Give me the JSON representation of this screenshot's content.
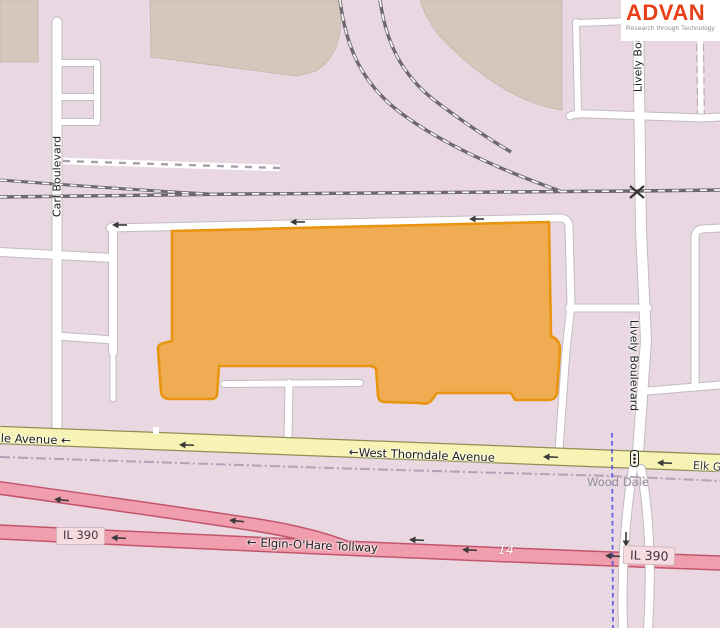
{
  "logo": {
    "brand": "ADVAN",
    "tagline": "Research through Technology",
    "brand_color": "#e8401a"
  },
  "map": {
    "street_labels": {
      "carl_boulevard": "Carl Boulevard",
      "lively_boulevard": "Lively Boulevard",
      "west_thorndale_avenue": "West Thorndale Avenue",
      "thorndale_avenue_cut": "le Avenue",
      "elgin_ohare_tollway": "Elgin-O'Hare Tollway",
      "elk_grove_cut": "Elk Gr"
    },
    "place_labels": {
      "wood_dale": "Wood Dale"
    },
    "route_shields": {
      "il_390": "IL 390",
      "route_14": "14"
    },
    "glyphs": {
      "oneway_arrow_left": "←"
    },
    "colors": {
      "background": "#e9d8e2",
      "building_block": "#d3c8bb",
      "highlight_building_fill": "#f0ac52",
      "highlight_building_stroke": "#e8940e",
      "road_white": "#ffffff",
      "road_casing": "#c3bbc3",
      "road_yellow": "#f7f3b5",
      "road_yellow_casing": "#908e55",
      "road_pink": "#f09dad",
      "road_pink_casing": "#c2556b",
      "railway_gray": "#6f696f",
      "boundary_blue": "#4d4de0",
      "boundary_purple": "#ab9cb3",
      "shield_bg": "#f5dce1",
      "shield_text": "#49323f"
    }
  }
}
